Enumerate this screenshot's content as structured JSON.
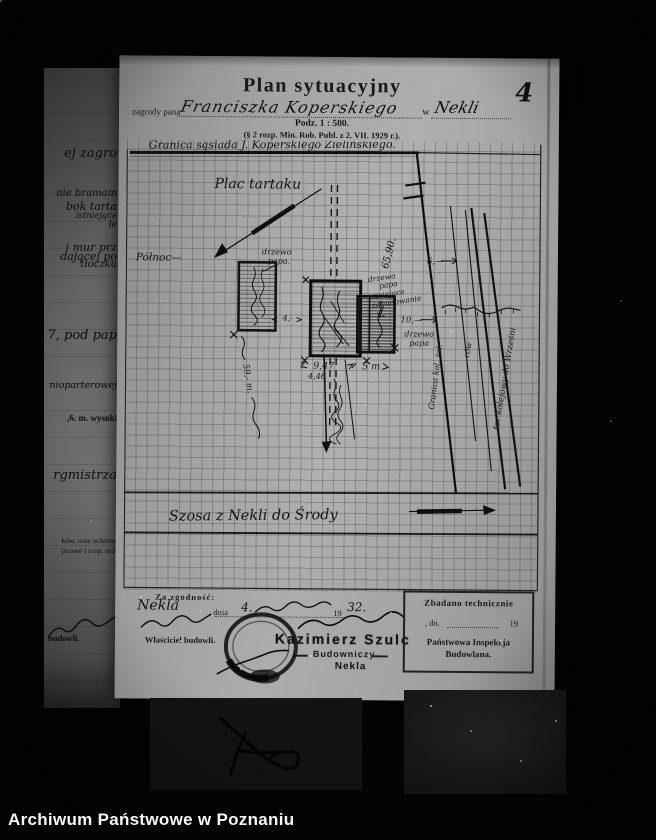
{
  "photo": {
    "archive_caption": "Archiwum Państwowe w Poznaniu",
    "page_number": "4"
  },
  "header": {
    "title": "Plan sytuacyjny",
    "prefix": "zagrody pana",
    "owner": "Franciszka Koperskiego",
    "w": "w",
    "place": "Nekli",
    "scale": "Podz. 1 : 500.",
    "regulation": "(§ 2 rozp. Min. Rob. Publ. z 2. VII. 1929 r.)."
  },
  "plan": {
    "boundary_top": "Granica sąsiada J. Koperskiego Zielińskiego.",
    "site": "Plac tartaku",
    "north": "Północ—",
    "tree1_l1": "drzewo",
    "tree1_l2": "papa.",
    "ann_l1": "drzewo",
    "ann_l2": "papa",
    "ann_l3": "istniejące",
    "ann_l4": "zabudowanie",
    "tree3_l1": "drzewo",
    "tree3_l2": "papa",
    "m_6590": "65,90.",
    "m_6": "6,—",
    "m_10": "10,—",
    "m_947": "9,47",
    "m_446": "4,46",
    "m_5m": "5 m",
    "m_4": "4,-",
    "m_59": "59,- m.",
    "rail_granica": "Granica kol. żel.",
    "rail_row": "rów",
    "rail_tor": "tor kolejowy do Wrześni",
    "road": "Szosa z Nekli do Środy"
  },
  "certification": {
    "za": "Za zgodność:",
    "place": "Nekla",
    "dnia": ", dnia",
    "date": "4.",
    "year_print": "19",
    "year_hand": "32.",
    "owner_label": "Właściciel budowli.",
    "stamp_name": "Kazimierz Szulc",
    "stamp_role": "Budowniczy",
    "stamp_place": "Nekla"
  },
  "inspection": {
    "l1": "Zbadano technicznie",
    "l2a": ", dn.",
    "l2b": "19",
    "l3": "Państwowa Inspekcja",
    "l4": "Budowlana."
  },
  "behind_fragments": [
    "ej zagro",
    "nie bramam",
    "bok tarta",
    "istniejące",
    "le",
    "i mur prz",
    "dającej po",
    "tłoczku",
    "7, pod pap",
    "nioparterowej",
    ",6.  m. wysoki",
    "rgmistrza",
    "ków, oraz ochrony",
    "jscowe i rozp. ord.",
    "budowli."
  ]
}
